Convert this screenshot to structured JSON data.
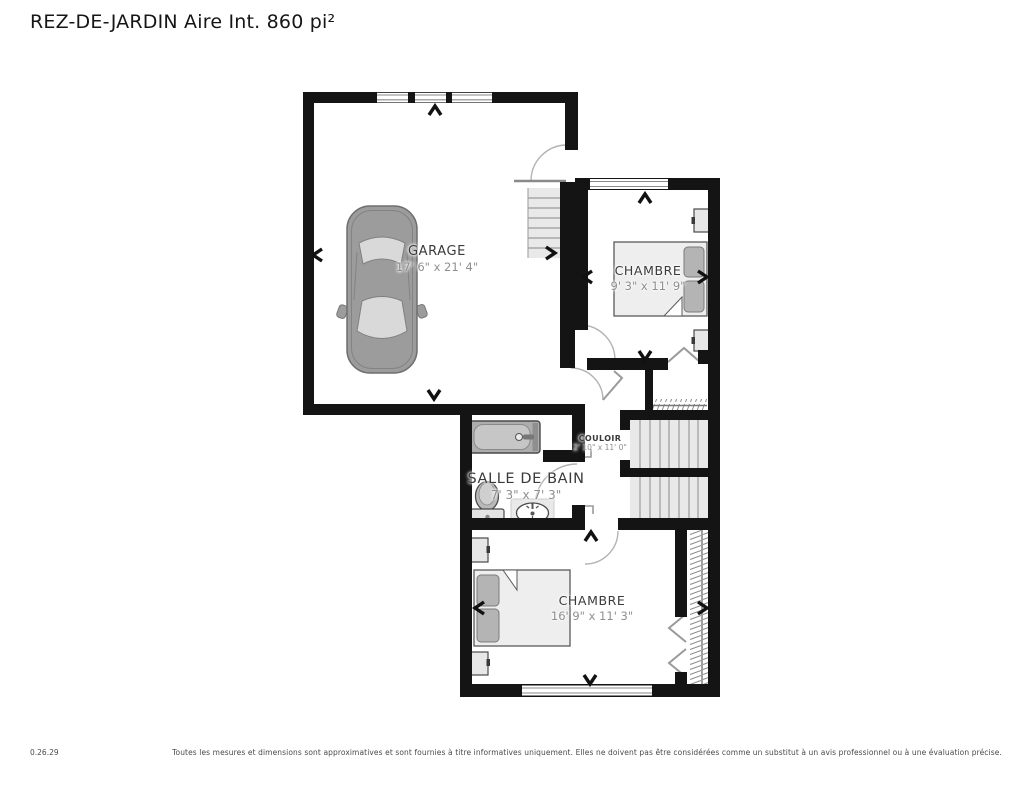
{
  "title": "REZ-DE-JARDIN Aire Int. 860 pi²",
  "rooms": {
    "garage": {
      "name": "GARAGE",
      "dimensions": "17' 6\" x 21' 4\""
    },
    "chambre1": {
      "name": "CHAMBRE",
      "dimensions": "9' 3\" x 11' 9\""
    },
    "couloir": {
      "name": "COULOIR",
      "dimensions": "2' 10\" x 11' 0\""
    },
    "salle_de_bain": {
      "name": "SALLE DE BAIN",
      "dimensions": "7' 3\" x 7' 3\""
    },
    "chambre2": {
      "name": "CHAMBRE",
      "dimensions": "16' 9\" x 11' 3\""
    }
  },
  "footer": {
    "version": "0.26.29",
    "disclaimer": "Toutes les mesures et dimensions sont approximatives et sont fournies à titre informatives uniquement. Elles ne doivent pas être considérées comme un substitut à un avis professionnel ou à une évaluation précise."
  },
  "colors": {
    "wall": "#141414",
    "stair_fill": "#e9e9e9",
    "furniture_fill": "#eeeeee",
    "pillow_fill": "#b4b4b4",
    "label": "#3a3a3a",
    "dimension": "#8f8f8f"
  }
}
